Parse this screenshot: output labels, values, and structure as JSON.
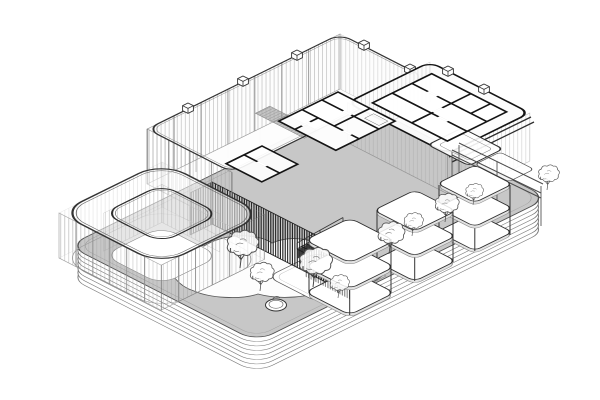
{
  "meta": {
    "domain": "architectural drawing",
    "projection": "isometric axonometric",
    "style": "black-and-white technical linework, cutaway floor plan on stepped plinth",
    "background": "#ffffff"
  },
  "palette": {
    "background": "#ffffff",
    "line_bold": "#141414",
    "line_dark": "#333333",
    "line_mid": "#666666",
    "line_light": "#999999",
    "glass_hatch": "#a3a3a3",
    "terrace_gray": "#c7c7c7",
    "floor_white": "#fdfdfd",
    "slab_gray": "#e2e2e2",
    "louver_dark": "#1b1b1b",
    "stair_shadow": "#2f2f2f",
    "roof_strip_gray": "#c4c4c4"
  },
  "scene": {
    "plinth": {
      "label": "stepped terrace plinth",
      "layers": 7
    },
    "pavilion": {
      "label": "rounded-square glass pavilion with open inner courtyard"
    },
    "main_building": {
      "label": "cutaway main building: glazed upper floor with interior partition walls",
      "wings": 2,
      "roof_vents": 7
    },
    "louver_facade": {
      "label": "dark vertical-louver facade band"
    },
    "staircase": {
      "label": "external straight stair",
      "treads": 11
    },
    "towers": {
      "label": "framed two-storey pavilion towers on the terrace",
      "count": 3
    },
    "pergola": {
      "label": "open beam frame structure"
    },
    "landscape": {
      "lawn": "organic white lawn patch",
      "platform": "rounded-square deck",
      "planter": "round planter pot",
      "trees": 9
    }
  }
}
